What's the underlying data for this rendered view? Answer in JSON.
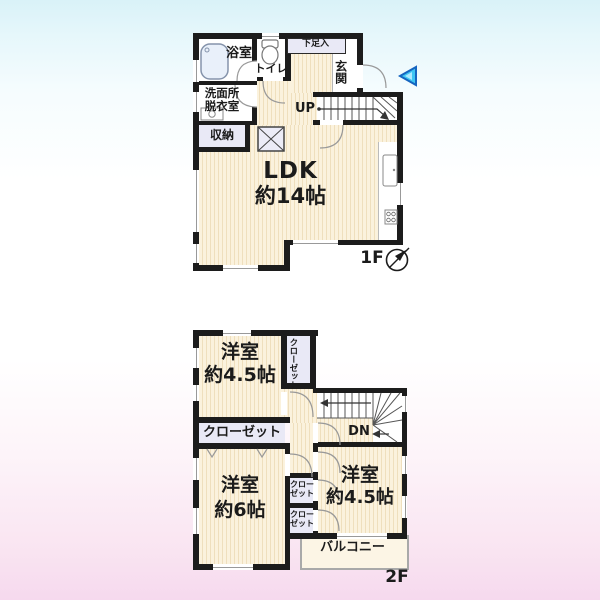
{
  "floor1": {
    "floor_label": "1F",
    "rooms": {
      "bath": "浴室",
      "toilet": "トイレ",
      "washroom_l1": "洗面所",
      "washroom_l2": "脱衣室",
      "storage": "収納",
      "shoe_box": "下足入",
      "entrance": "玄関",
      "up": "UP",
      "ldk_l1": "LDK",
      "ldk_l2": "約14帖"
    }
  },
  "floor2": {
    "floor_label": "2F",
    "rooms": {
      "room_nw_l1": "洋室",
      "room_nw_l2": "約4.5帖",
      "closet_vert_c1": "クロー",
      "closet_vert_c2": "ゼット",
      "closet_wide": "クローゼット",
      "room_sw_l1": "洋室",
      "room_sw_l2": "約6帖",
      "room_se_l1": "洋室",
      "room_se_l2": "約4.5帖",
      "closet_small_l1": "クロー",
      "closet_small_l2": "ゼット",
      "dn": "DN",
      "balcony": "バルコニー"
    }
  },
  "colors": {
    "wall": "#1c1c1c",
    "tatami_base": "#fbf2dd",
    "tatami_stripe": "#efdfbd",
    "closet_fill": "#e9e9f6",
    "entrance_arrow_blue": "#3ec6f3",
    "background_top": "#d9f2f8",
    "background_bottom": "#f6d9ee"
  }
}
